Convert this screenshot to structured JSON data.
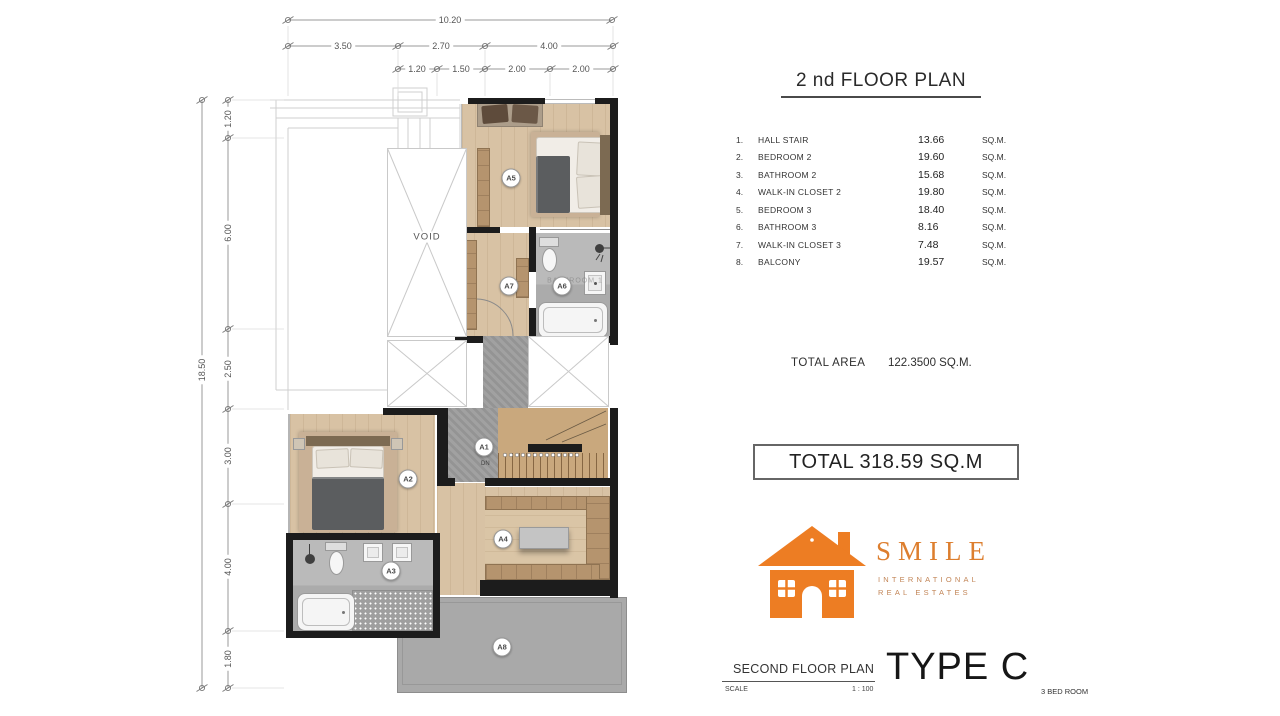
{
  "header": {
    "title": "2 nd FLOOR PLAN"
  },
  "room_table": {
    "rows": [
      {
        "no": "1.",
        "name": "HALL STAIR",
        "area": "13.66",
        "unit": "SQ.M."
      },
      {
        "no": "2.",
        "name": "BEDROOM 2",
        "area": "19.60",
        "unit": "SQ.M."
      },
      {
        "no": "3.",
        "name": "BATHROOM 2",
        "area": "15.68",
        "unit": "SQ.M."
      },
      {
        "no": "4.",
        "name": "WALK-IN CLOSET 2",
        "area": "19.80",
        "unit": "SQ.M."
      },
      {
        "no": "5.",
        "name": "BEDROOM 3",
        "area": "18.40",
        "unit": "SQ.M."
      },
      {
        "no": "6.",
        "name": "BATHROOM 3",
        "area": "8.16",
        "unit": "SQ.M."
      },
      {
        "no": "7.",
        "name": "WALK-IN CLOSET 3",
        "area": "7.48",
        "unit": "SQ.M."
      },
      {
        "no": "8.",
        "name": "BALCONY",
        "area": "19.57",
        "unit": "SQ.M."
      }
    ]
  },
  "total_area": {
    "label": "TOTAL AREA",
    "value": "122.3500 SQ.M."
  },
  "total_box": {
    "text": "TOTAL 318.59 SQ.M"
  },
  "logo": {
    "brand": "SMILE",
    "sub1": "INTERNATIONAL",
    "sub2": "REAL ESTATES",
    "accent": "#ed7d23"
  },
  "title_block": {
    "plan_name": "SECOND FLOOR PLAN",
    "scale_label": "SCALE",
    "scale_value": "1 : 100",
    "type_name": "TYPE C",
    "type_sub": "3 BED ROOM"
  },
  "plan": {
    "void_label": "VOID",
    "stair_note": "DN",
    "watermark": "BATHROOM 1",
    "labels": {
      "a1": "A1",
      "a2": "A2",
      "a3": "A3",
      "a4": "A4",
      "a5": "A5",
      "a6": "A6",
      "a7": "A7",
      "a8": "A8"
    },
    "dims": {
      "top_total": "10.20",
      "top_row2": [
        "3.50",
        "2.70",
        "4.00"
      ],
      "top_row3": [
        "1.20",
        "1.50",
        "2.00",
        "2.00"
      ],
      "left_total": "18.50",
      "left_segments": [
        "1.20",
        "6.00",
        "2.50",
        "3.00",
        "4.00",
        "1.80"
      ]
    },
    "colors": {
      "wall": "#1c1c1c",
      "wood": "#d8c2a4",
      "cabinet": "#b5946e",
      "tile": "#b4b4b4",
      "balcony": "#a9a9a9",
      "brand_orange": "#ed7d23"
    }
  }
}
